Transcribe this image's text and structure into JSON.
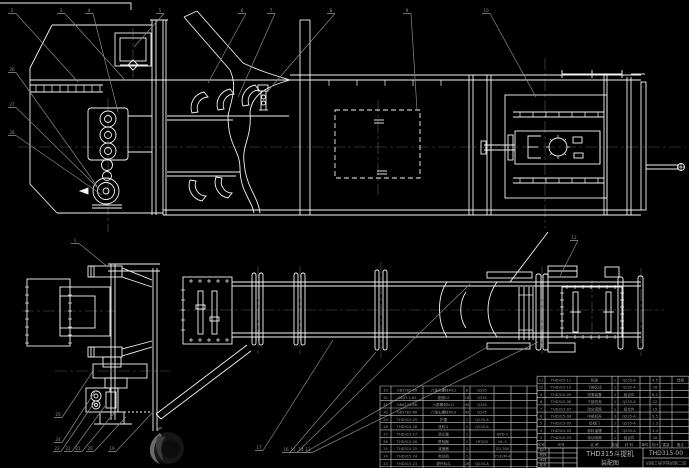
{
  "colors": {
    "background": "#000000",
    "line": "#f5f5f5",
    "leader": "#8a8a8a",
    "table_line": "#c9c9c9",
    "table_text": "#9b9b9b",
    "title_text": "#b5b5b5"
  },
  "title_block": {
    "title": "THD315斗提机",
    "subtitle": "装配图",
    "drawing_number": "THD315-00",
    "org": "机械工程学院机制二班",
    "stamp_rows": [
      [
        "设计",
        "",
        ""
      ],
      [
        "校核",
        "",
        ""
      ],
      [
        "审核",
        "",
        ""
      ],
      [
        "批准",
        "",
        ""
      ]
    ]
  },
  "bom_right": {
    "header": [
      "序号",
      "代号",
      "名 称",
      "数量",
      "材 料",
      "单件",
      "总计",
      "重量",
      "备注"
    ],
    "rows": [
      [
        "11",
        "THD315-11",
        "机座",
        "1",
        "Q235-A",
        "",
        "4.5",
        "",
        "焊接"
      ],
      [
        "10",
        "THD315-10",
        "下部区段",
        "1",
        "Q235-A",
        "",
        "16",
        "",
        ""
      ],
      [
        "9",
        "THD315-09",
        "张紧装置",
        "1",
        "组合件",
        "",
        "8.2",
        "",
        ""
      ],
      [
        "8",
        "THD315-08",
        "下部机壳",
        "1",
        "Q235-A",
        "",
        "12",
        "",
        ""
      ],
      [
        "7",
        "THD315-07",
        "改向滚筒",
        "1",
        "组合件",
        "",
        "15",
        "",
        ""
      ],
      [
        "6",
        "THD315-06",
        "中部机壳",
        "3",
        "Q235-A",
        "",
        "9.5",
        "",
        ""
      ],
      [
        "5",
        "THD315-05",
        "检视门",
        "1",
        "Q235-A",
        "",
        "1.2",
        "",
        ""
      ],
      [
        "4",
        "THD315-04",
        "卸料溜槽",
        "1",
        "Q235-A",
        "",
        "3.4",
        "",
        ""
      ],
      [
        "3",
        "THD315-03",
        "传动滚筒",
        "1",
        "组合件",
        "",
        "18",
        "",
        ""
      ]
    ]
  },
  "bom_left": {
    "rows": [
      [
        "33",
        "GB5782-86",
        "六角头螺栓M12",
        "8",
        "Q235",
        "",
        "",
        ""
      ],
      [
        "32",
        "GB97.1-85",
        "垫圈12",
        "16",
        "Q235",
        "",
        "",
        ""
      ],
      [
        "31",
        "GB6170-86",
        "六角螺母M12",
        "40",
        "Q235",
        "",
        "",
        ""
      ],
      [
        "30",
        "GB5782-86",
        "六角头螺栓M10",
        "40",
        "Q235",
        "",
        "",
        ""
      ],
      [
        "29",
        "THD315-29",
        "护罩",
        "1",
        "Q235-A",
        "",
        "",
        ""
      ],
      [
        "28",
        "THD315-28",
        "进料斗",
        "1",
        "Q235-A",
        "",
        "",
        ""
      ],
      [
        "27",
        "THD315-27",
        "逆止器",
        "1",
        "",
        "NYD-2",
        "",
        ""
      ],
      [
        "26",
        "THD315-26",
        "联轴器",
        "1",
        "HT200",
        "HL-3",
        "",
        ""
      ],
      [
        "25",
        "THD315-25",
        "减速器",
        "1",
        "",
        "ZQ-350",
        "",
        ""
      ],
      [
        "24",
        "THD315-24",
        "电动机",
        "1",
        "",
        "Y132M-4",
        "",
        ""
      ],
      [
        "23",
        "THD315-23",
        "提升料斗",
        "26",
        "Q235-A",
        "",
        "",
        ""
      ],
      [
        "22",
        "THD315-22",
        "螺旋张紧",
        "2",
        "Q235",
        "",
        "",
        ""
      ]
    ]
  },
  "balloons": [
    {
      "t": "2",
      "x": 12,
      "y": 12,
      "tx": 78,
      "ty": 82
    },
    {
      "t": "3",
      "x": 61,
      "y": 12,
      "tx": 125,
      "ty": 80
    },
    {
      "t": "4",
      "x": 89,
      "y": 12,
      "tx": 118,
      "ty": 112
    },
    {
      "t": "5",
      "x": 160,
      "y": 12,
      "tx": 134,
      "ty": 47
    },
    {
      "t": "6",
      "x": 242,
      "y": 12,
      "tx": 208,
      "ty": 83
    },
    {
      "t": "7",
      "x": 271,
      "y": 12,
      "tx": 238,
      "ty": 97
    },
    {
      "t": "8",
      "x": 331,
      "y": 12,
      "tx": 267,
      "ty": 92
    },
    {
      "t": "9",
      "x": 407,
      "y": 12,
      "tx": 417,
      "ty": 110
    },
    {
      "t": "10",
      "x": 486,
      "y": 12,
      "tx": 536,
      "ty": 97
    },
    {
      "t": "26",
      "x": 12,
      "y": 71,
      "tx": 97,
      "ty": 186
    },
    {
      "t": "27",
      "x": 12,
      "y": 106,
      "tx": 100,
      "ty": 190
    },
    {
      "t": "28",
      "x": 12,
      "y": 134,
      "tx": 102,
      "ty": 195
    },
    {
      "t": "1",
      "x": 75,
      "y": 242,
      "tx": 108,
      "ty": 267
    },
    {
      "t": "12",
      "x": 574,
      "y": 239,
      "tx": 560,
      "ty": 276
    },
    {
      "t": "25",
      "x": 58,
      "y": 416,
      "tx": 93,
      "ty": 371
    },
    {
      "t": "24",
      "x": 58,
      "y": 441,
      "tx": 96,
      "ty": 390
    },
    {
      "t": "23",
      "x": 57,
      "y": 450,
      "tx": 96,
      "ty": 400
    },
    {
      "t": "22",
      "x": 68,
      "y": 450,
      "tx": 105,
      "ty": 406
    },
    {
      "t": "21",
      "x": 78,
      "y": 450,
      "tx": 115,
      "ty": 412
    },
    {
      "t": "20",
      "x": 90,
      "y": 450,
      "tx": 126,
      "ty": 417
    },
    {
      "t": "19",
      "x": 112,
      "y": 450,
      "tx": 152,
      "ty": 413
    },
    {
      "t": "17",
      "x": 259,
      "y": 449,
      "tx": 333,
      "ty": 340
    },
    {
      "t": "16",
      "x": 286,
      "y": 451,
      "tx": 376,
      "ty": 352
    },
    {
      "t": "15",
      "x": 293,
      "y": 451,
      "tx": 470,
      "ty": 284
    },
    {
      "t": "14",
      "x": 301,
      "y": 451,
      "tx": 489,
      "ty": 346
    },
    {
      "t": "13",
      "x": 308,
      "y": 451,
      "tx": 538,
      "ty": 342
    }
  ],
  "watermark": {
    "outer": "#6a6a6a",
    "mid": "#3c3c3c",
    "inner": "#0d0d0d"
  }
}
